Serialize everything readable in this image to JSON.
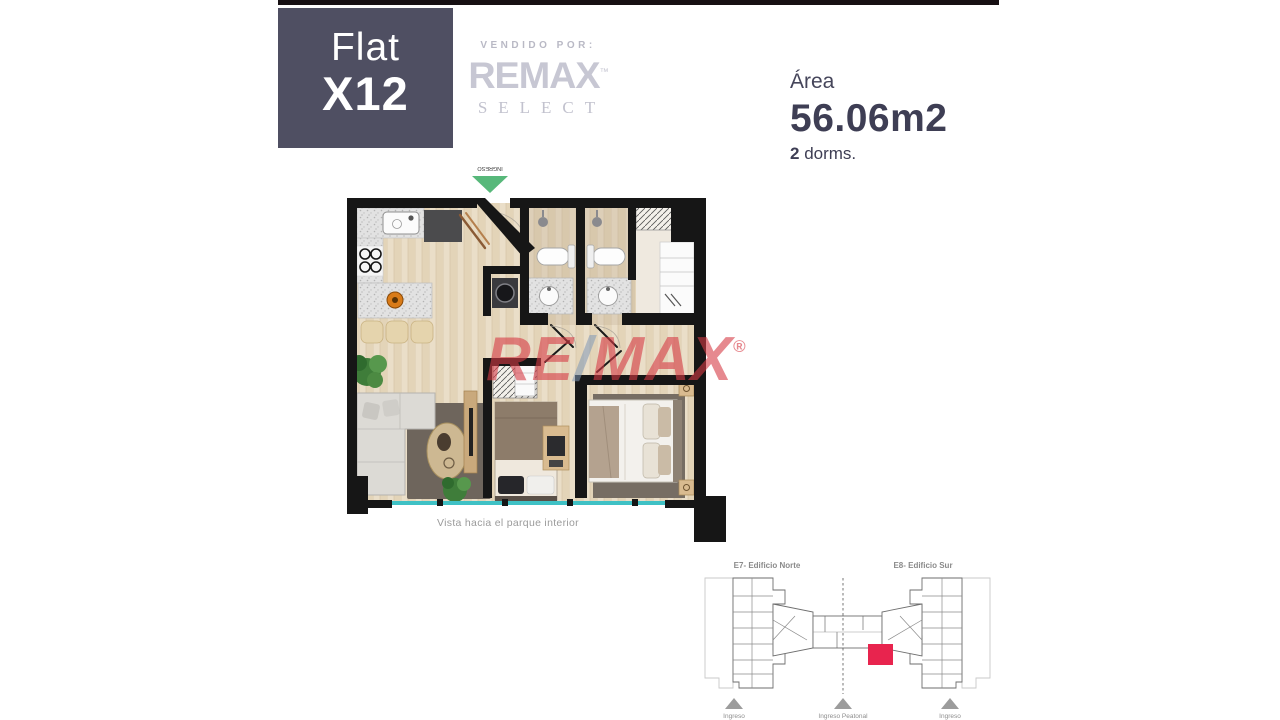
{
  "header": {
    "unit_line1": "Flat",
    "unit_line2": "X12",
    "sold_by_label": "VENDIDO POR:",
    "brand_name": "REMAX",
    "brand_tm": "™",
    "brand_division": "SELECT",
    "area_label": "Área",
    "area_value": "56.06m2",
    "dorms_count": "2",
    "dorms_label": " dorms."
  },
  "floorplan": {
    "entry_label": "INGRESO",
    "caption": "Vista hacia el parque interior",
    "watermark_part1": "RE",
    "watermark_slash": "/",
    "watermark_part2": "MAX",
    "watermark_registered": "®"
  },
  "siteplan": {
    "building_north_label": "E7- Edificio Norte",
    "building_south_label": "E8- Edificio Sur",
    "entrance_left_label": "Ingreso",
    "entrance_center_label": "Ingreso Peatonal",
    "entrance_right_label": "Ingreso",
    "highlight_color": "#e8244e"
  },
  "colors": {
    "accent_green": "#57b87a",
    "glass_teal": "#3fc1c5"
  }
}
